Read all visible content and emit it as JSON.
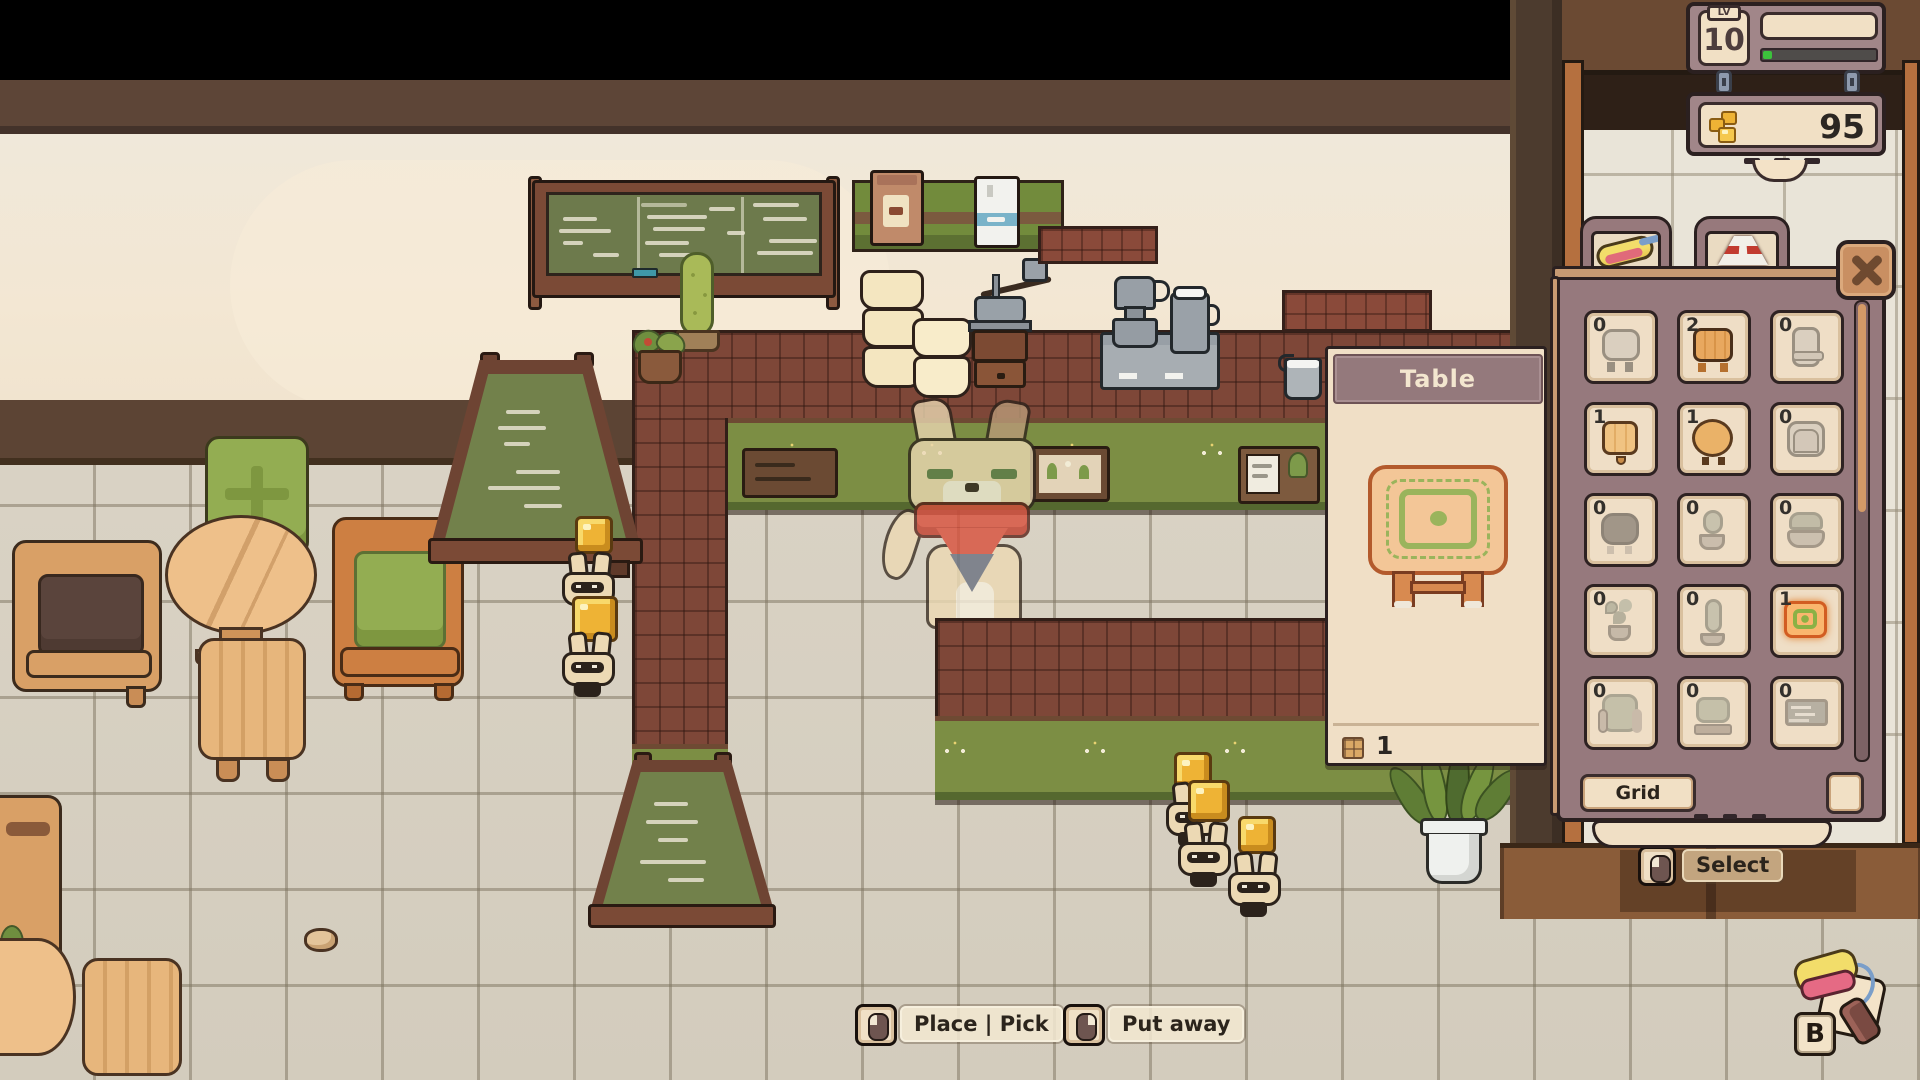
{
  "hud": {
    "level_label": "LV",
    "level_value": "10",
    "xp_fill_percent": 8,
    "currency_value": "95"
  },
  "info_panel": {
    "title": "Table",
    "count": "1"
  },
  "inventory": {
    "tabs": [
      {
        "icon": "crepe-tab-icon"
      },
      {
        "icon": "sign-tab-icon"
      }
    ],
    "items": [
      {
        "name": "stool",
        "count": "0",
        "owned": false,
        "selected": false
      },
      {
        "name": "bench",
        "count": "2",
        "owned": true,
        "selected": false
      },
      {
        "name": "chair-back",
        "count": "0",
        "owned": false,
        "selected": false
      },
      {
        "name": "side-table",
        "count": "1",
        "owned": true,
        "selected": false
      },
      {
        "name": "round-table",
        "count": "1",
        "owned": true,
        "selected": false
      },
      {
        "name": "armchair",
        "count": "0",
        "owned": false,
        "selected": false
      },
      {
        "name": "pouf",
        "count": "0",
        "owned": false,
        "selected": false
      },
      {
        "name": "cactus-pot",
        "count": "0",
        "owned": false,
        "selected": false
      },
      {
        "name": "plant-bowl",
        "count": "0",
        "owned": false,
        "selected": false
      },
      {
        "name": "leaf-plant",
        "count": "0",
        "owned": false,
        "selected": false
      },
      {
        "name": "tall-cactus",
        "count": "0",
        "owned": false,
        "selected": false
      },
      {
        "name": "mat-table",
        "count": "1",
        "owned": true,
        "selected": true
      },
      {
        "name": "green-armchair",
        "count": "0",
        "owned": false,
        "selected": false
      },
      {
        "name": "green-seat",
        "count": "0",
        "owned": false,
        "selected": false
      },
      {
        "name": "sign-board",
        "count": "0",
        "owned": false,
        "selected": false
      }
    ],
    "grid_toggle_label": "Grid Toggle",
    "select_label": "Select"
  },
  "actions": {
    "place_pick_label": "Place | Pick",
    "put_away_label": "Put away",
    "build_key_label": "B"
  },
  "colors": {
    "panel_mauve": "#96797d",
    "cream": "#f1e0c5",
    "accent_orange": "#cd9064",
    "counter_red": "#7e4738",
    "counter_green": "#7c8e44",
    "gold": "#eeb335",
    "xp_green": "#3cc13c",
    "chalk_green": "#6d7a4c"
  }
}
